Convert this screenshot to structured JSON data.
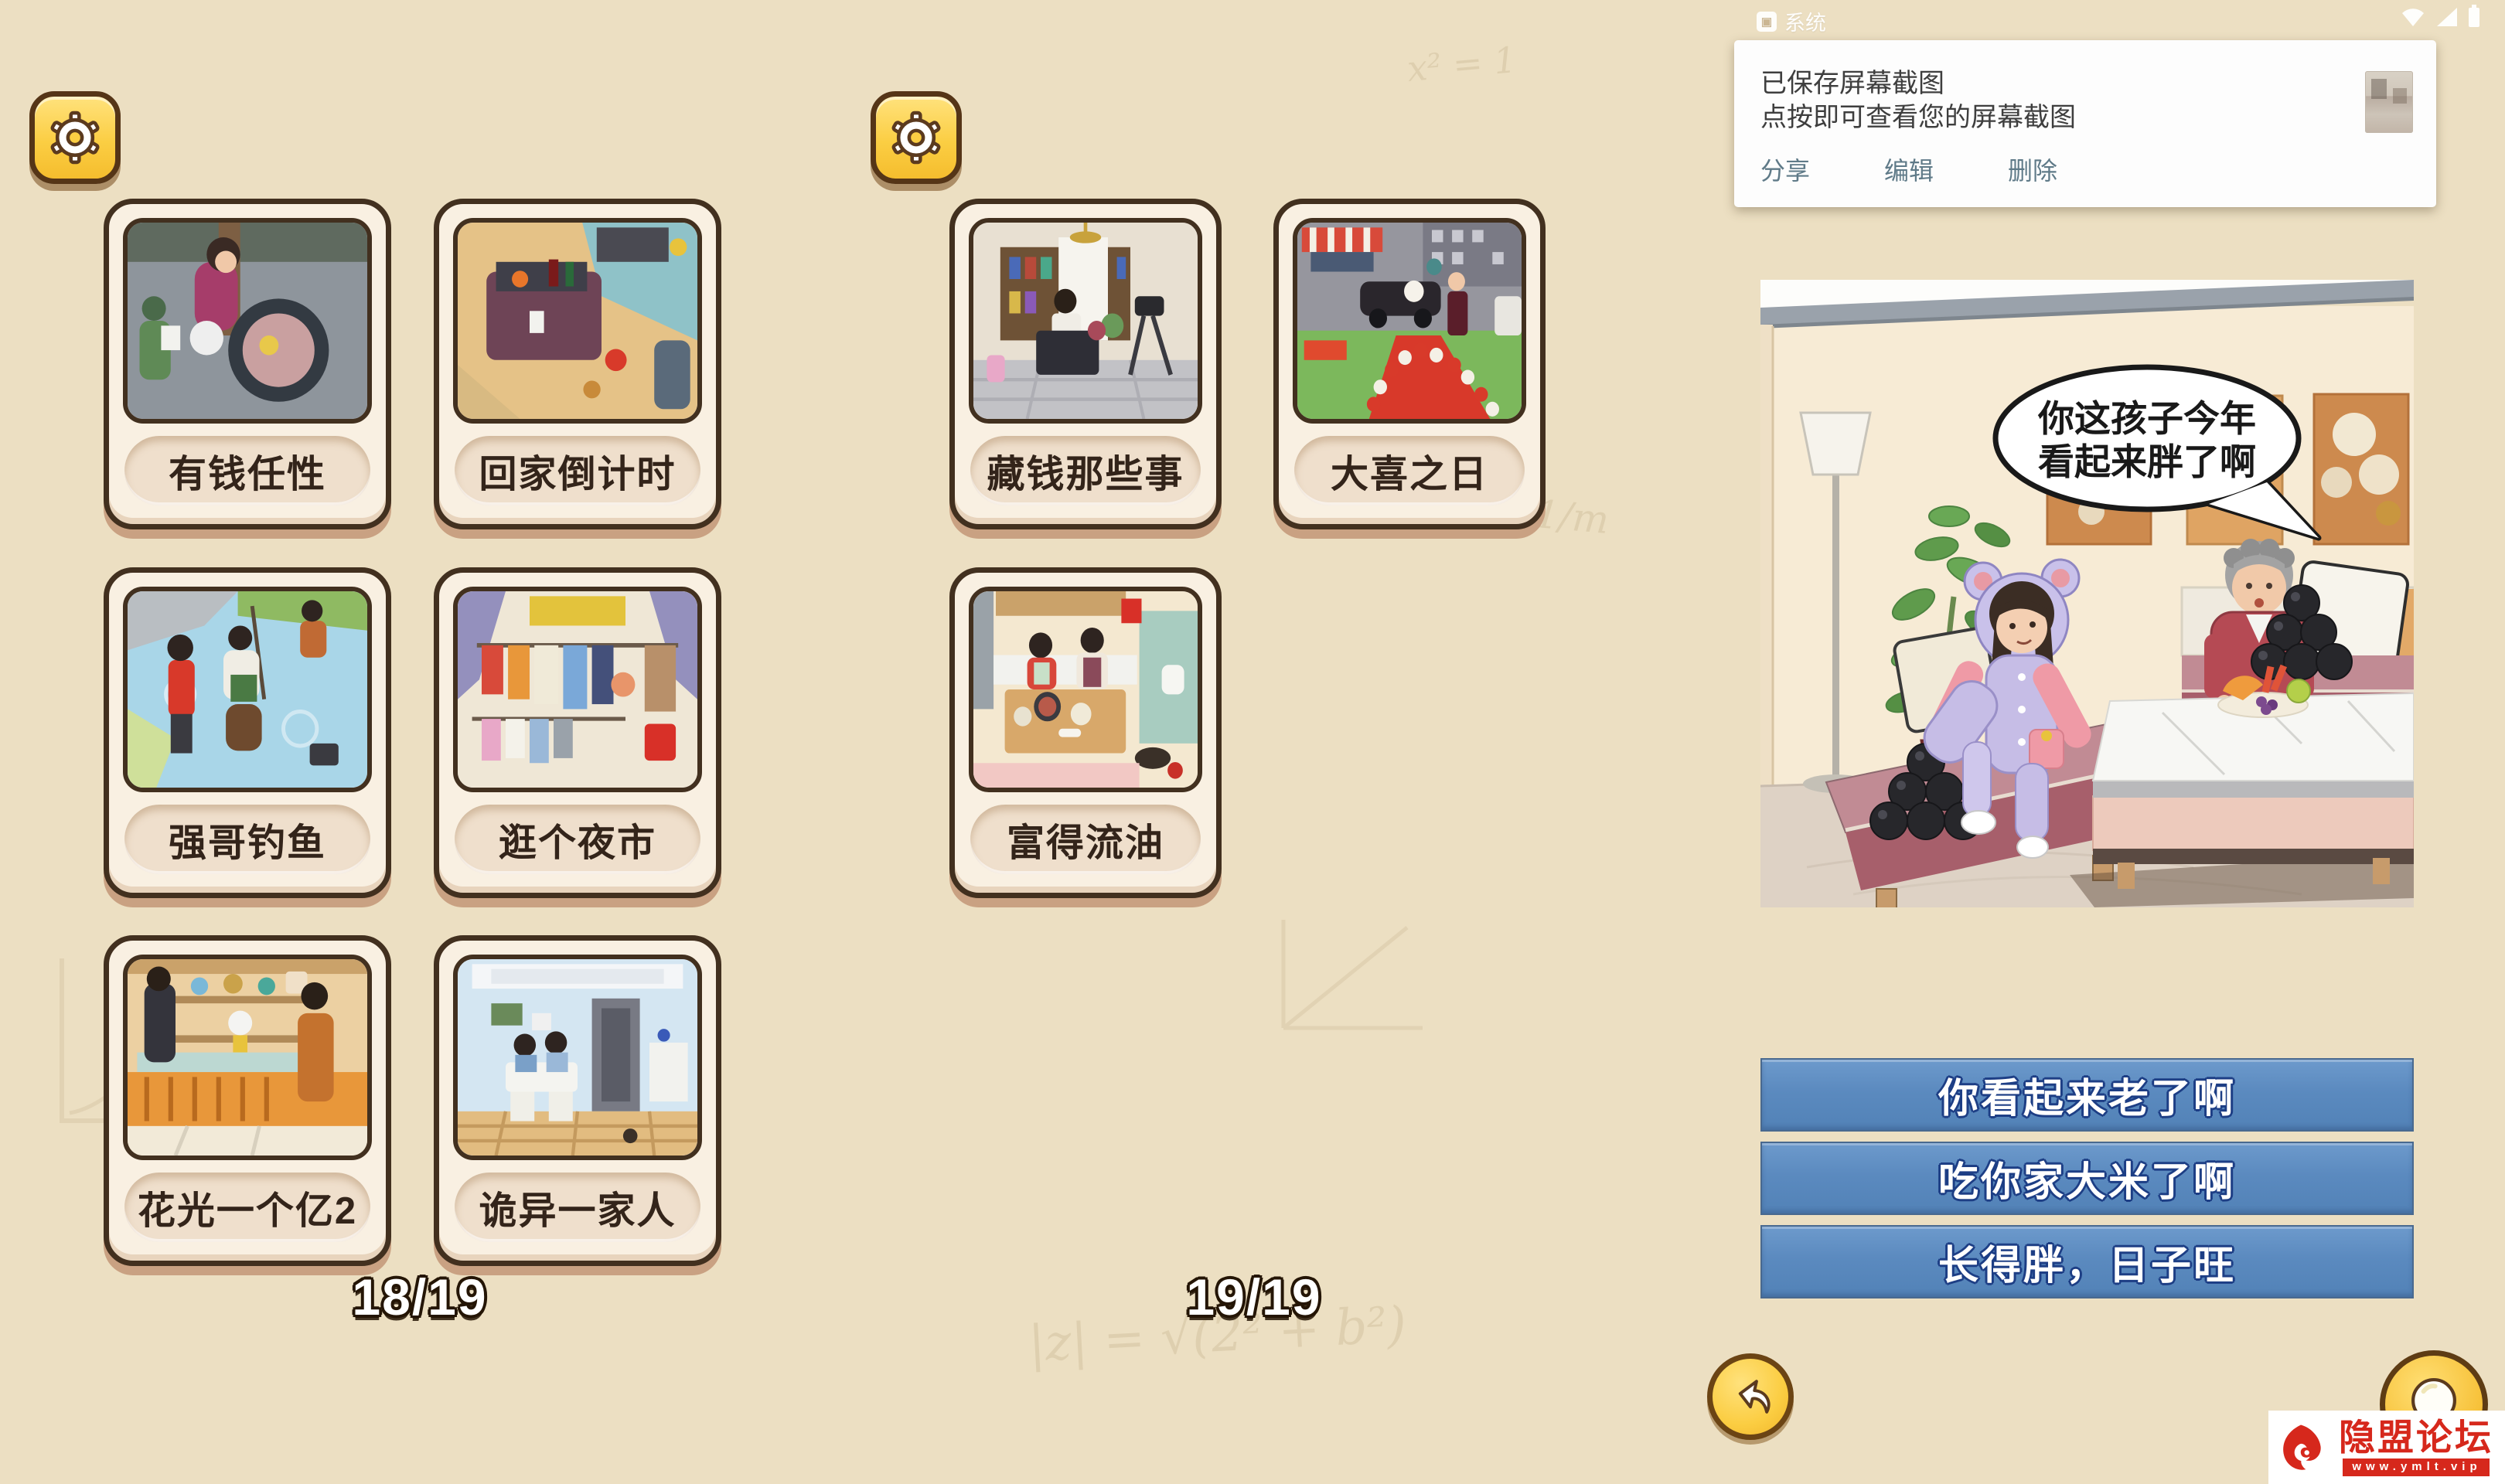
{
  "status_bar": {
    "app_label": "系统",
    "icons": [
      "notification-icon",
      "wifi-icon",
      "signal-icon",
      "battery-icon"
    ]
  },
  "notification": {
    "title": "已保存屏幕截图",
    "subtitle": "点按即可查看您的屏幕截图",
    "actions": [
      {
        "label": "分享"
      },
      {
        "label": "编辑"
      },
      {
        "label": "删除"
      }
    ]
  },
  "pages": [
    {
      "indicator": "18/19",
      "cards": [
        {
          "label": "有钱任性"
        },
        {
          "label": "回家倒计时"
        },
        {
          "label": "强哥钓鱼"
        },
        {
          "label": "逛个夜市"
        },
        {
          "label": "花光一个亿2"
        },
        {
          "label": "诡异一家人"
        }
      ]
    },
    {
      "indicator": "19/19",
      "cards": [
        {
          "label": "藏钱那些事"
        },
        {
          "label": "大喜之日"
        },
        {
          "label": "富得流油"
        }
      ]
    }
  ],
  "scene": {
    "speech_bubble": {
      "line1": "你这孩子今年",
      "line2": "看起来胖了啊"
    }
  },
  "answers": [
    {
      "label": "你看起来老了啊"
    },
    {
      "label": "吃你家大米了啊"
    },
    {
      "label": "长得胖，日子旺"
    }
  ],
  "watermark": {
    "site_name": "隐盟论坛",
    "site_url": "www.ymlt.vip"
  },
  "background": {
    "doodles": [
      "|z| = √(2² + b²)",
      "1/m",
      "x² = 1"
    ]
  },
  "colors": {
    "background_tan": "#ecdfc2",
    "card_cream": "#f9f0e2",
    "card_border_brown": "#42301f",
    "accent_yellow": "#fbce43",
    "answer_blue": "#5b8abf",
    "watermark_red": "#d6281c"
  }
}
